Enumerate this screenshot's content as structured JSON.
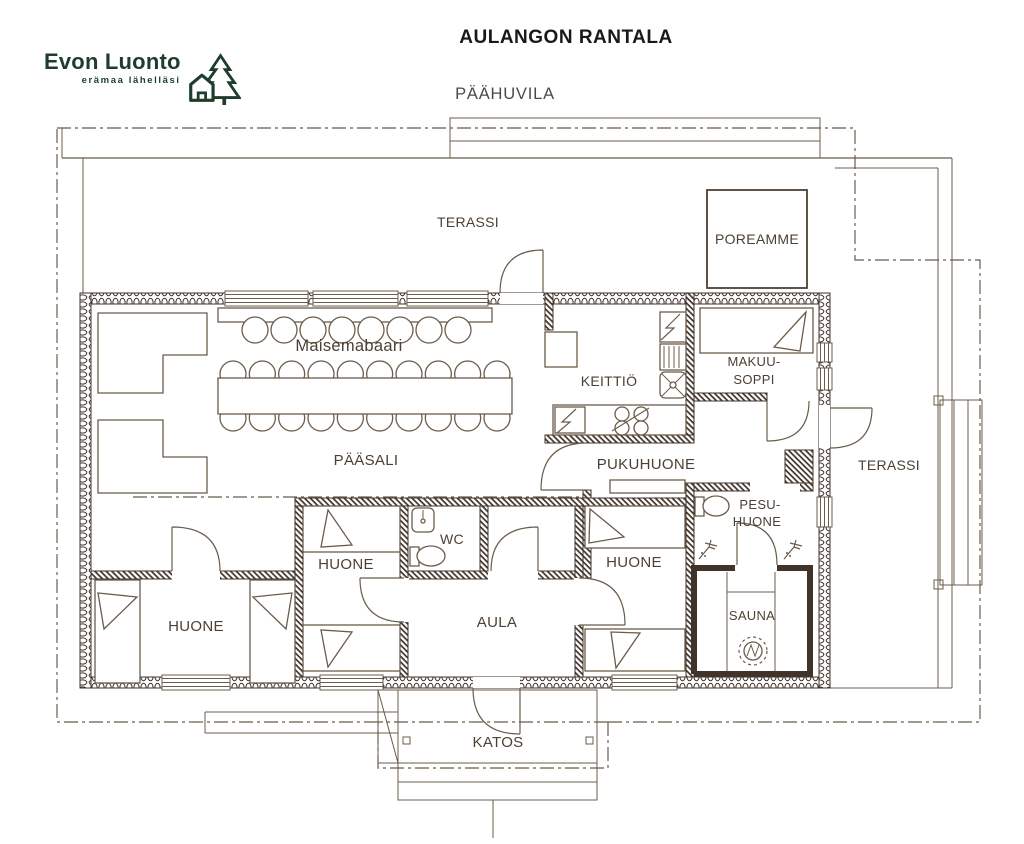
{
  "logo": {
    "name": "Evon Luonto",
    "tagline": "erämaa lähelläsi",
    "icon": "house-and-spruce-icon",
    "color": "#1e3d2c"
  },
  "header": {
    "title": "AULANGON RANTALA",
    "subtitle": "PÄÄHUVILA"
  },
  "rooms": {
    "terrace_top": {
      "label": "TERASSI"
    },
    "poreamme": {
      "label": "POREAMME"
    },
    "maisemabaari": {
      "label": "Maisemabaari"
    },
    "keittio": {
      "label": "KEITTIÖ"
    },
    "makuusoppi": {
      "label_line1": "MAKUU-",
      "label_line2": "SOPPI"
    },
    "paasali": {
      "label": "PÄÄSALI"
    },
    "pukuhuone": {
      "label": "PUKUHUONE"
    },
    "terrace_right": {
      "label": "TERASSI"
    },
    "pesuhuone": {
      "label_line1": "PESU-",
      "label_line2": "HUONE"
    },
    "wc": {
      "label": "WC"
    },
    "huone_left": {
      "label": "HUONE"
    },
    "huone_middle": {
      "label": "HUONE"
    },
    "huone_right": {
      "label": "HUONE"
    },
    "aula": {
      "label": "AULA"
    },
    "sauna": {
      "label": "SAUNA"
    },
    "katos": {
      "label": "KATOS"
    }
  },
  "furniture": {
    "bar_stools": 8,
    "dining_chairs_per_side": 10
  },
  "colors": {
    "line": "#6b5c4b",
    "wall": "#40332a",
    "label": "#4c4034",
    "logo_green": "#1e3d2c",
    "title": "#191917",
    "subtitle": "#4b4a45"
  }
}
